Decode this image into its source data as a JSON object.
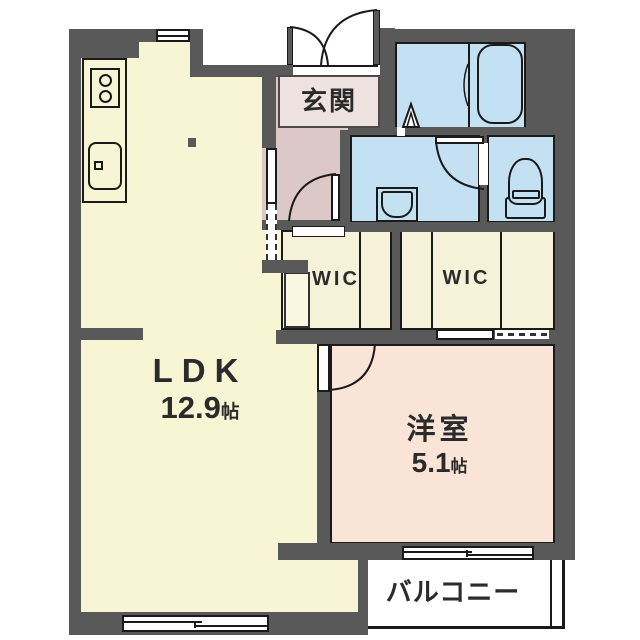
{
  "plan": {
    "rooms": {
      "genkan": {
        "label": "玄関"
      },
      "ldk": {
        "label": "LDK",
        "size": "12.9",
        "unit": "帖"
      },
      "western": {
        "label": "洋室",
        "size": "5.1",
        "unit": "帖"
      },
      "wic1": {
        "label": "WIC"
      },
      "wic2": {
        "label": "WIC"
      },
      "balcony": {
        "label": "バルコニー"
      }
    },
    "colors": {
      "wall": "#595959",
      "outline": "#1a1a1a",
      "ldk": "#f7f5d4",
      "hall": "#dcc8c7",
      "genkan": "#efe3e2",
      "wet": "#c3e1f2",
      "wic": "#f6f2da",
      "west": "#fae4d7",
      "balcony": "#ffffff",
      "text": "#2b2b2b"
    }
  }
}
